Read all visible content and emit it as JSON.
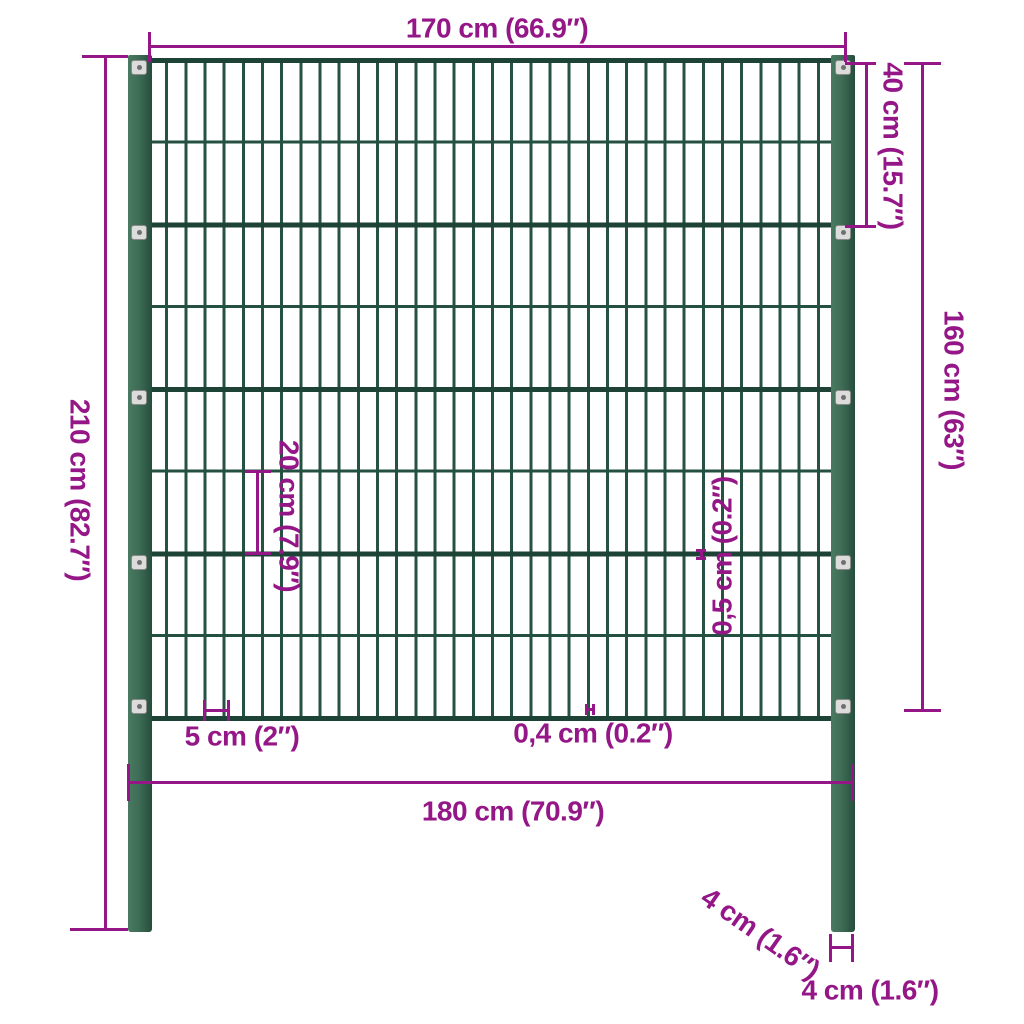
{
  "diagram": {
    "title": "Fence panel with posts - dimension diagram",
    "colors": {
      "dimension_accent": "#941687",
      "post_green": "#3E6C55",
      "wire_green_thick": "#1C4336",
      "wire_green_thin": "#235041",
      "clip_gray": "#DCDCDC",
      "background": "#FFFFFF"
    },
    "labels": {
      "top_width": "170 cm (66.9″)",
      "upper_section_height": "40 cm (15.7″)",
      "panel_height": "160 cm (63″)",
      "post_height": "210 cm (82.7″)",
      "mesh_opening_height": "20 cm (7.9″)",
      "horizontal_wire_thickness": "0,5 cm (0.2″)",
      "mesh_opening_width": "5 cm (2″)",
      "vertical_wire_thickness": "0,4 cm (0.2″)",
      "bottom_width": "180 cm (70.9″)",
      "post_depth": "4 cm (1.6″)",
      "post_width": "4 cm (1.6″)"
    }
  }
}
